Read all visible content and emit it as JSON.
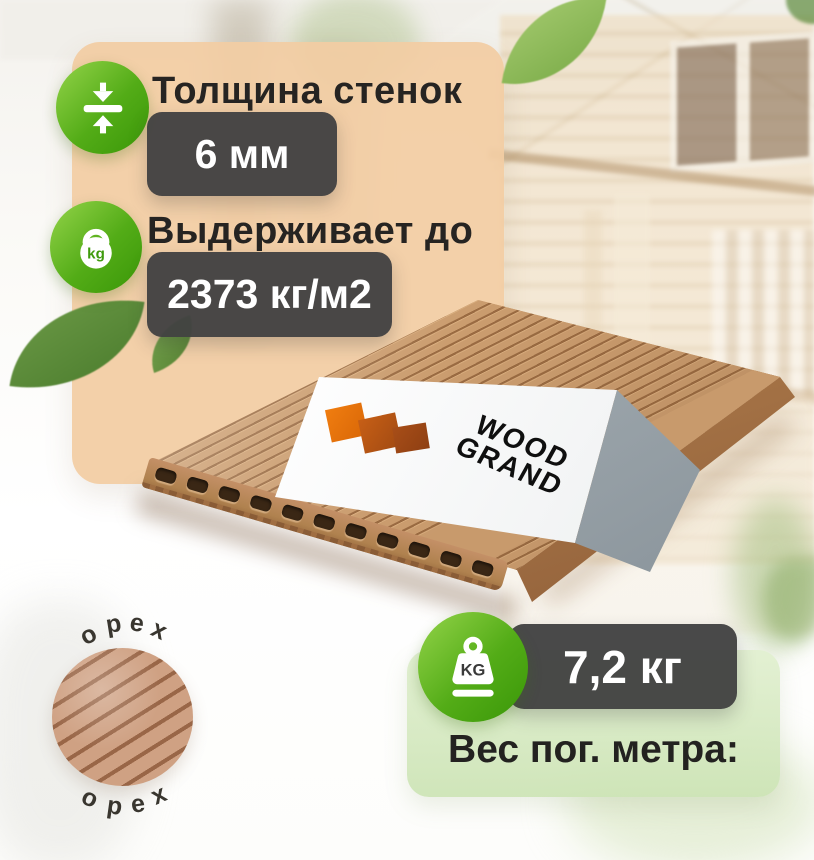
{
  "specs": [
    {
      "icon": "thickness-icon",
      "label": "Толщина стенок",
      "value": "6 мм"
    },
    {
      "icon": "kettlebell-icon",
      "label": "Выдерживает до",
      "value": "2373 кг/м2"
    }
  ],
  "weight": {
    "icon": "weight-kg-icon",
    "icon_text": "KG",
    "value": "7,2 кг",
    "label": "Вес пог. метра:"
  },
  "kettlebell_icon_text": "kg",
  "swatch": {
    "top": "орех",
    "bottom": "орех"
  },
  "brand": {
    "line1": "WOOD",
    "line2": "GRAND"
  },
  "colors": {
    "accent_green": "#4aa40e",
    "badge_dark": "#424242",
    "panel_peach": "#f2cca2",
    "panel_green": "#d9ecc6",
    "board_tan": "#c89a6c",
    "board_groove": "#9a6b42",
    "logo_orange": "#ee7a0e",
    "label_gray": "#98a2a8"
  }
}
